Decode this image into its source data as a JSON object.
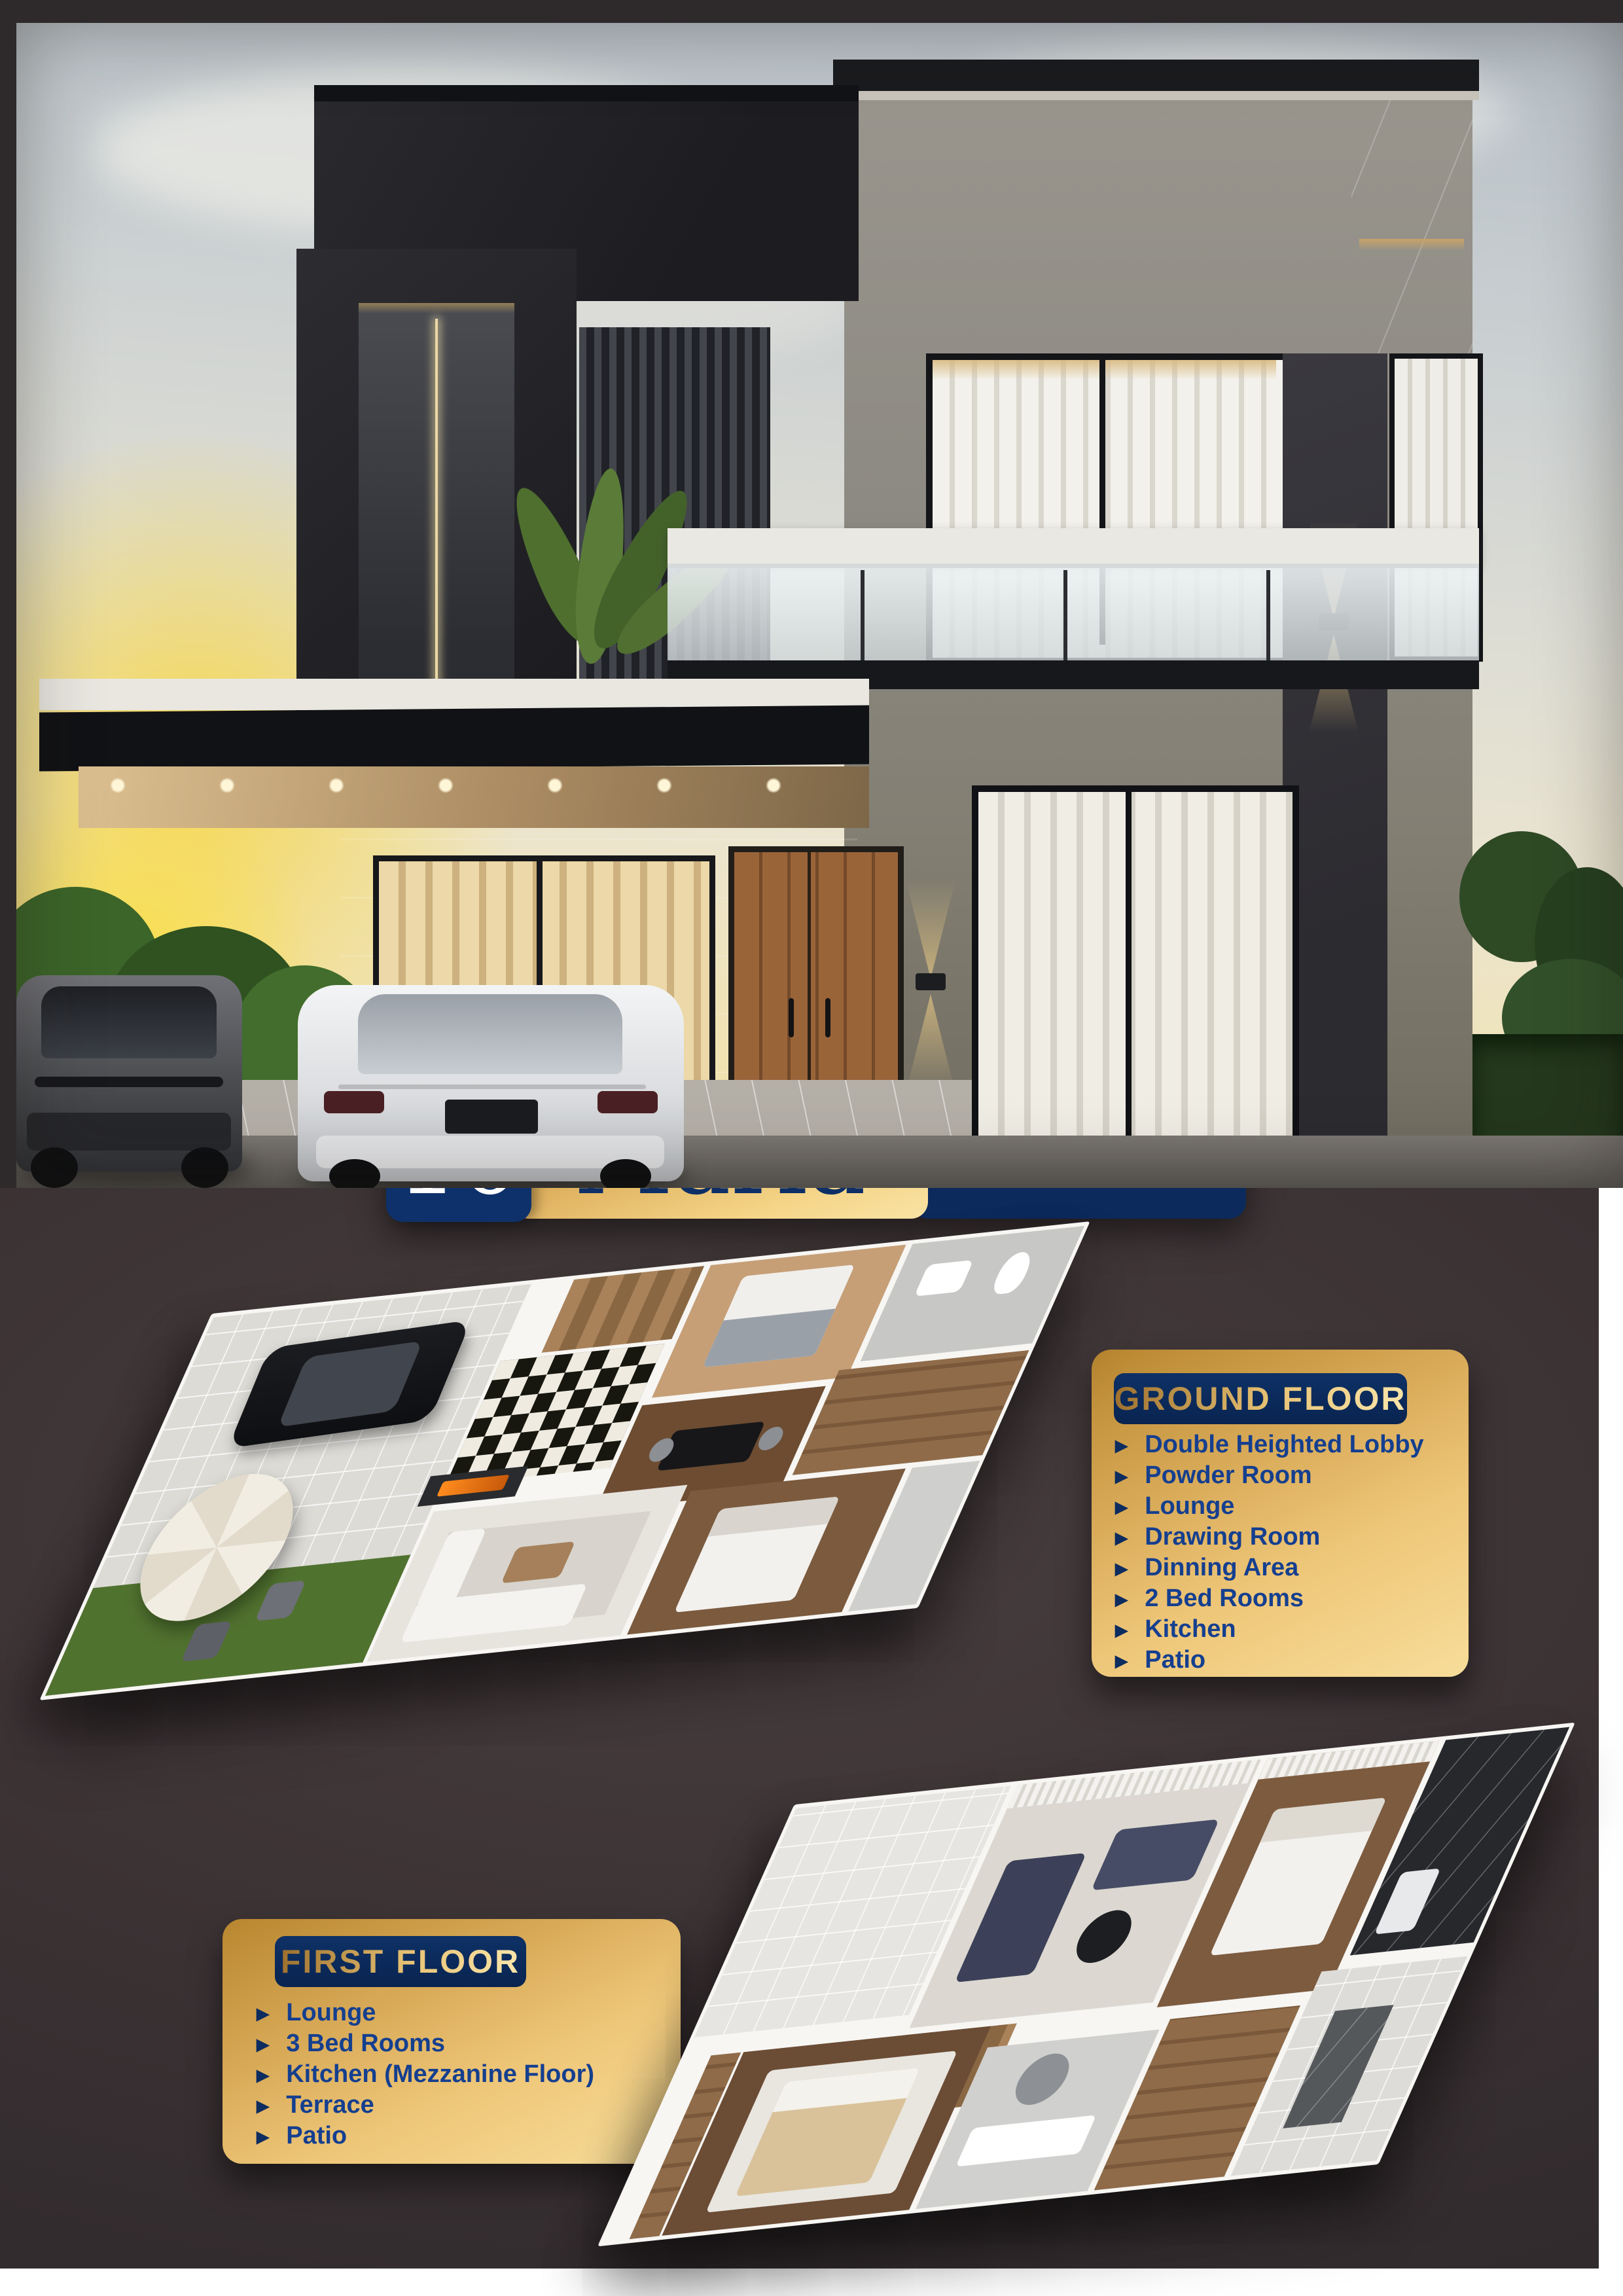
{
  "colors": {
    "navy": "#0d2c5f",
    "gold_dark": "#b8862f",
    "gold_light": "#f7dd9a",
    "list_text": "#153f8f",
    "background_dark": "#3a3133",
    "paper": "#ffffff"
  },
  "icons": {
    "bullet": "▶"
  },
  "badge": {
    "number": "10",
    "name": "Marla",
    "type": "VILLAS"
  },
  "ground_floor": {
    "title": "GROUND FLOOR",
    "items": [
      "Double Heighted Lobby",
      "Powder Room",
      "Lounge",
      "Drawing Room",
      "Dinning Area",
      "2 Bed Rooms",
      "Kitchen",
      "Patio"
    ]
  },
  "first_floor": {
    "title": "FIRST FLOOR",
    "items": [
      "Lounge",
      "3 Bed Rooms",
      "Kitchen (Mezzanine Floor)",
      "Terrace",
      "Patio"
    ]
  }
}
